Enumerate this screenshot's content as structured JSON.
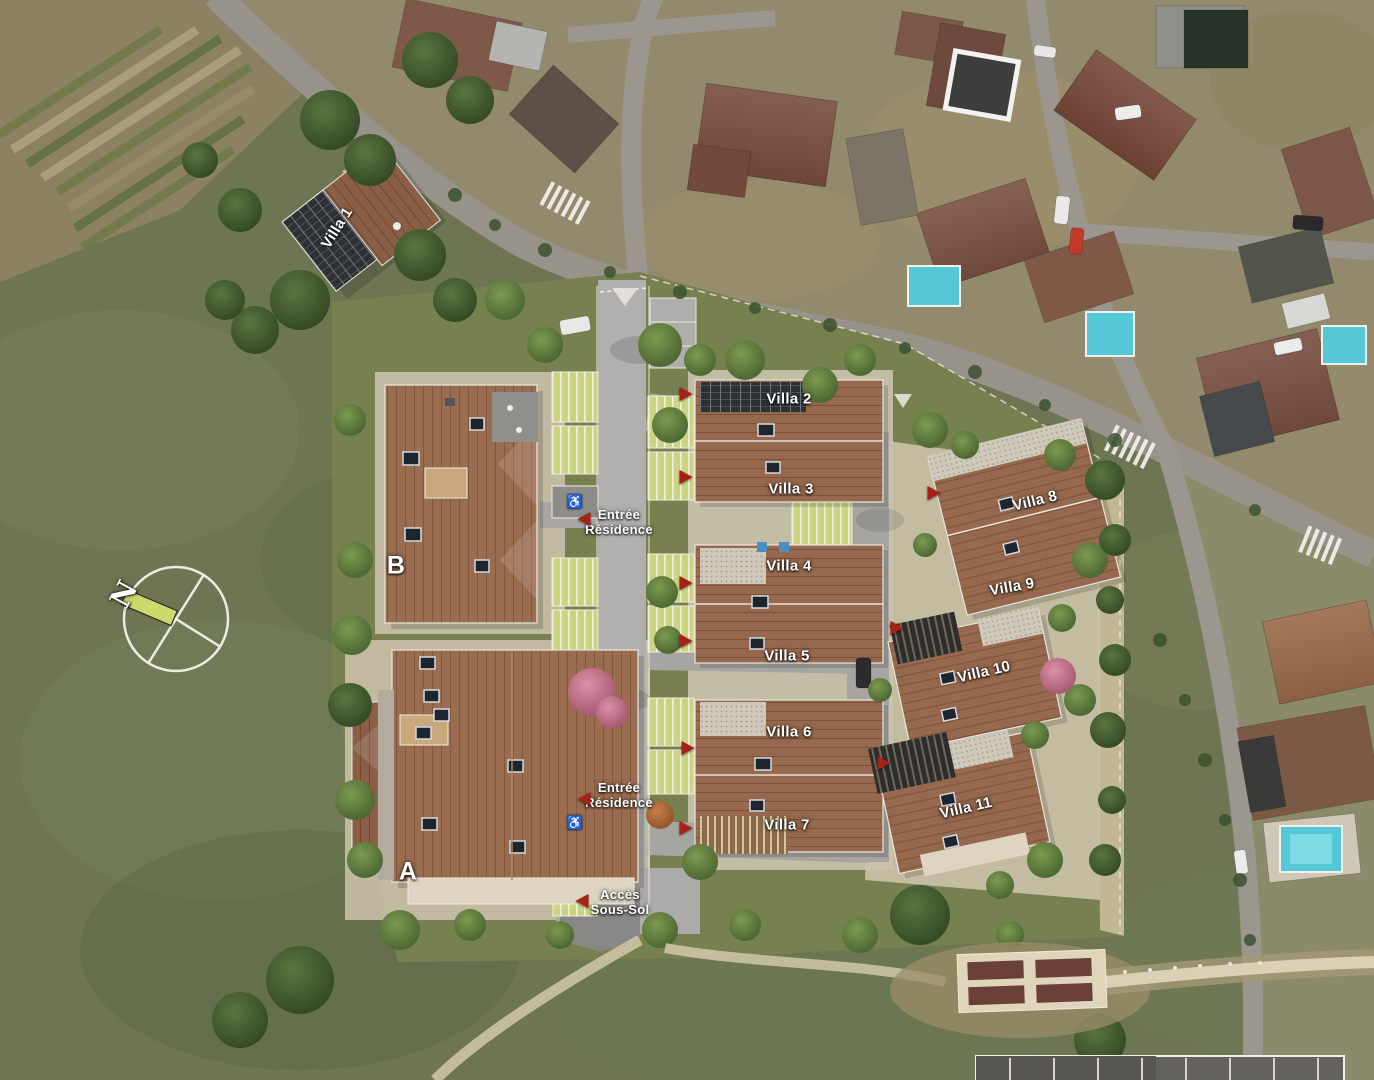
{
  "map": {
    "villas": [
      {
        "label": "Villa 1"
      },
      {
        "label": "Villa 2"
      },
      {
        "label": "Villa 3"
      },
      {
        "label": "Villa 4"
      },
      {
        "label": "Villa 5"
      },
      {
        "label": "Villa 6"
      },
      {
        "label": "Villa 7"
      },
      {
        "label": "Villa 8"
      },
      {
        "label": "Villa 9"
      },
      {
        "label": "Villa 10"
      },
      {
        "label": "Villa 11"
      }
    ],
    "buildings": {
      "building_a": "A",
      "building_b": "B"
    },
    "annotations": {
      "entrance_top": {
        "line1": "Entrée",
        "line2": "Résidence"
      },
      "entrance_bottom": {
        "line1": "Entrée",
        "line2": "Résidence"
      },
      "basement_access": {
        "line1": "Accès",
        "line2": "Sous-Sol"
      }
    },
    "compass": {
      "north": "N"
    },
    "icons": {
      "handicap": "♿"
    },
    "colors": {
      "arrow_red": "#a62219",
      "label_text": "#ffffff",
      "compass_bar": "#ccd96b",
      "pool_blue": "#55c8d8",
      "villa_roof": "#96684d",
      "field_green": "#6d7553"
    }
  }
}
